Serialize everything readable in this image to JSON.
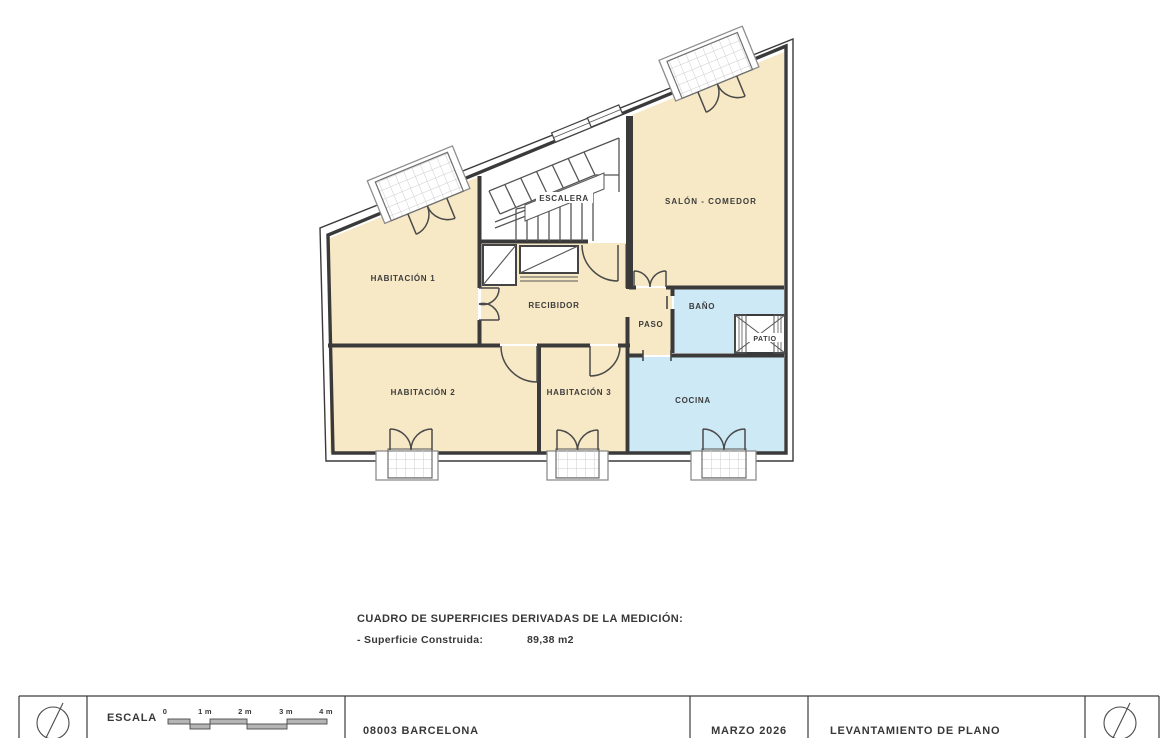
{
  "plan": {
    "rooms": {
      "hab1": "HABITACIÓN 1",
      "hab2": "HABITACIÓN 2",
      "hab3": "HABITACIÓN 3",
      "recibidor": "RECIBIDOR",
      "paso": "PASO",
      "bano": "BAÑO",
      "patio": "PATIO",
      "cocina": "COCINA",
      "salon": "SALÓN - COMEDOR",
      "escalera": "ESCALERA"
    }
  },
  "summary": {
    "title": "CUADRO DE SUPERFICIES DERIVADAS DE LA MEDICIÓN:",
    "item_label": "- Superficie Construida:",
    "item_value": "89,38 m2"
  },
  "title_block": {
    "scale_label": "ESCALA",
    "scale_ticks": [
      "0",
      "1 m",
      "2 m",
      "3 m",
      "4 m"
    ],
    "address": "08003 BARCELONA",
    "date": "MARZO 2026",
    "doc_title": "LEVANTAMIENTO DE PLANO"
  },
  "colors": {
    "cream": "#f8e9c6",
    "blue": "#cde9f6",
    "wall": "#3a3a3a",
    "text": "#3c3c3c",
    "line": "#555555",
    "hatch_line": "#cccccc",
    "scalebar_gray": "#b5b5b5"
  }
}
